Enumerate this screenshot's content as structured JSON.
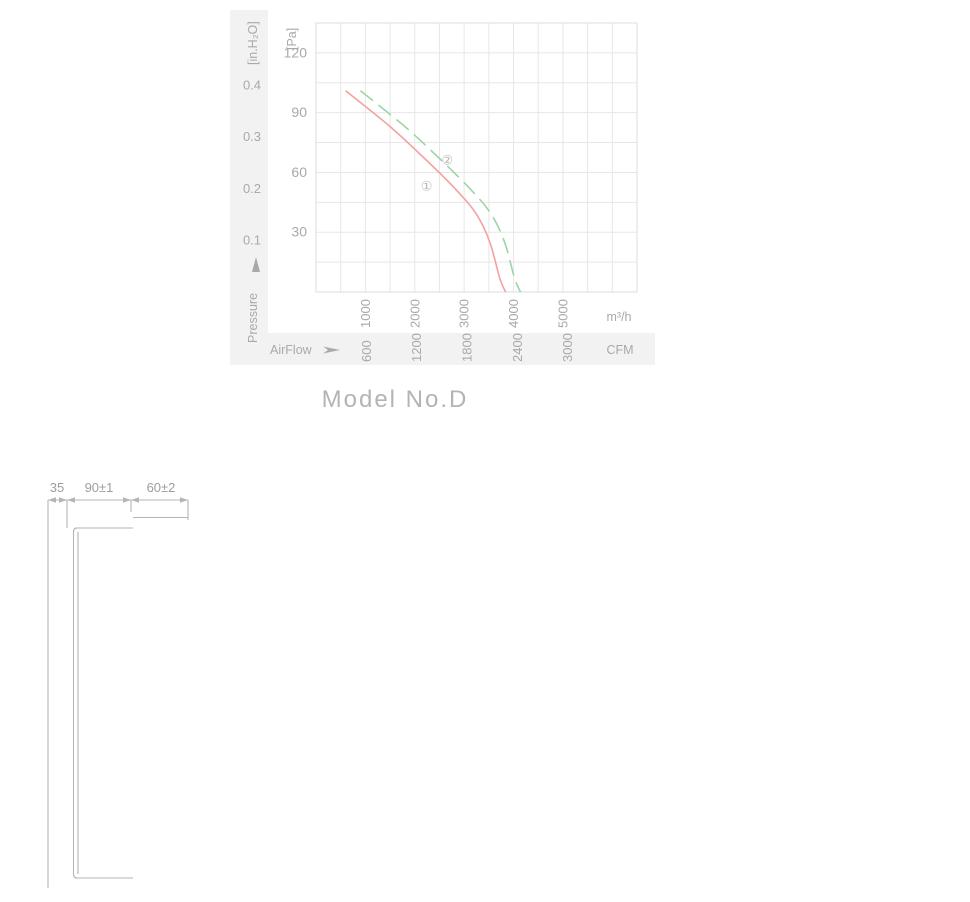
{
  "model_label": "Model No.D",
  "chart": {
    "left_axis": {
      "unit": "[in.H₂O]",
      "axis_label": "Pressure",
      "ticks": [
        0.4,
        0.3,
        0.2,
        0.1
      ]
    },
    "right_axis": {
      "unit": "[Pa]",
      "ticks": [
        120,
        90,
        60,
        30
      ]
    },
    "x_axis_primary": {
      "unit": "m³/h",
      "ticks": [
        1000,
        2000,
        3000,
        4000,
        5000
      ]
    },
    "x_axis_secondary": {
      "label": "AirFlow",
      "unit": "CFM",
      "ticks": [
        600,
        1200,
        1800,
        2400,
        3000
      ]
    },
    "colors": {
      "band": "#f2f2f2",
      "grid": "#e7e7e7",
      "frame": "#dedede",
      "text": "#a9a9a9",
      "curve1": "#f4a1a1",
      "curve2": "#9bd6a6"
    }
  },
  "chart_data": {
    "type": "line",
    "title": "",
    "xlabel": "AirFlow (m³/h)",
    "ylabel": "Pressure (Pa)",
    "xlim": [
      0,
      6500
    ],
    "ylim": [
      0,
      135
    ],
    "grid": true,
    "legend": "inline-circled-numbers",
    "x2_unit": "CFM",
    "m3h_per_cfm": 1.699,
    "y2_unit": "in.H₂O",
    "pa_per_inh2o": 260,
    "series": [
      {
        "name": "①",
        "color": "#f4a1a1",
        "style": "solid",
        "points": [
          [
            600,
            101
          ],
          [
            1500,
            83
          ],
          [
            2200,
            67
          ],
          [
            2850,
            51
          ],
          [
            3250,
            39
          ],
          [
            3520,
            25
          ],
          [
            3720,
            7
          ],
          [
            3840,
            0
          ]
        ],
        "label_at": [
          2240,
          53
        ]
      },
      {
        "name": "②",
        "color": "#9bd6a6",
        "style": "dashed",
        "points": [
          [
            900,
            101
          ],
          [
            1800,
            83
          ],
          [
            2500,
            67
          ],
          [
            3150,
            51
          ],
          [
            3550,
            39
          ],
          [
            3820,
            25
          ],
          [
            4020,
            7
          ],
          [
            4140,
            0
          ]
        ],
        "label_at": [
          2660,
          66
        ]
      }
    ]
  },
  "side_view": {
    "dims_top": [
      "35",
      "90±1",
      "60±2"
    ],
    "dim_hub": "Ø102",
    "dim_blade": {
      "text": "Ø420",
      "tol_upper": "0",
      "tol_lower": "-3"
    },
    "dim_overall": "Ø442±1.5"
  },
  "front_view": {
    "dim_hole": "Ø9",
    "dim_strip": "Ø5",
    "dim_outer": {
      "text": "Ø490",
      "tol_upper": "+2",
      "tol_lower": "0"
    }
  },
  "drawing_colors": {
    "line": "#b5b5b5",
    "line_soft": "#c4c4c4",
    "slot": "#ababab",
    "text": "#9d9d9d"
  }
}
